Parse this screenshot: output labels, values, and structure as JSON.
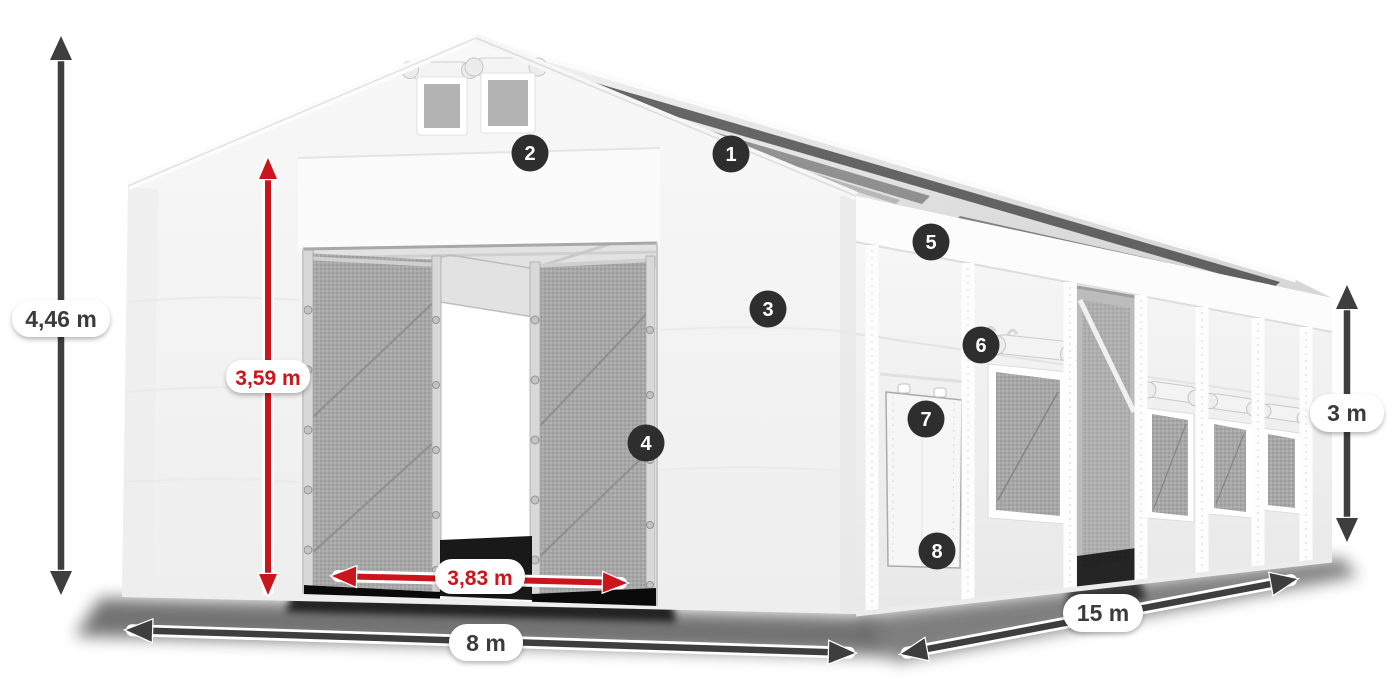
{
  "page": {
    "title": "Storage tent 8 x 15 m - dimension and feature diagram",
    "background": "#ffffff"
  },
  "dimensions": {
    "ridge_height": {
      "label": "4,46 m",
      "style": "dark"
    },
    "door_height": {
      "label": "3,59 m",
      "style": "red"
    },
    "door_width": {
      "label": "3,83 m",
      "style": "red"
    },
    "gable_width": {
      "label": "8 m",
      "style": "dark"
    },
    "side_length": {
      "label": "15 m",
      "style": "dark"
    },
    "eave_height": {
      "label": "3 m",
      "style": "dark"
    }
  },
  "feature_markers": [
    {
      "number": "1"
    },
    {
      "number": "2"
    },
    {
      "number": "3"
    },
    {
      "number": "4"
    },
    {
      "number": "5"
    },
    {
      "number": "6"
    },
    {
      "number": "7"
    },
    {
      "number": "8"
    }
  ],
  "colors": {
    "accent_red": "#c9151b",
    "arrow_dark": "#3e3e3e",
    "marker_bg": "#2e2e2e",
    "marker_text": "#ffffff",
    "pill_bg": "#ffffff",
    "pill_text": "#3b3b3b",
    "tent_white": "#f5f5f5",
    "mesh_gray": "#a7a7a7"
  }
}
